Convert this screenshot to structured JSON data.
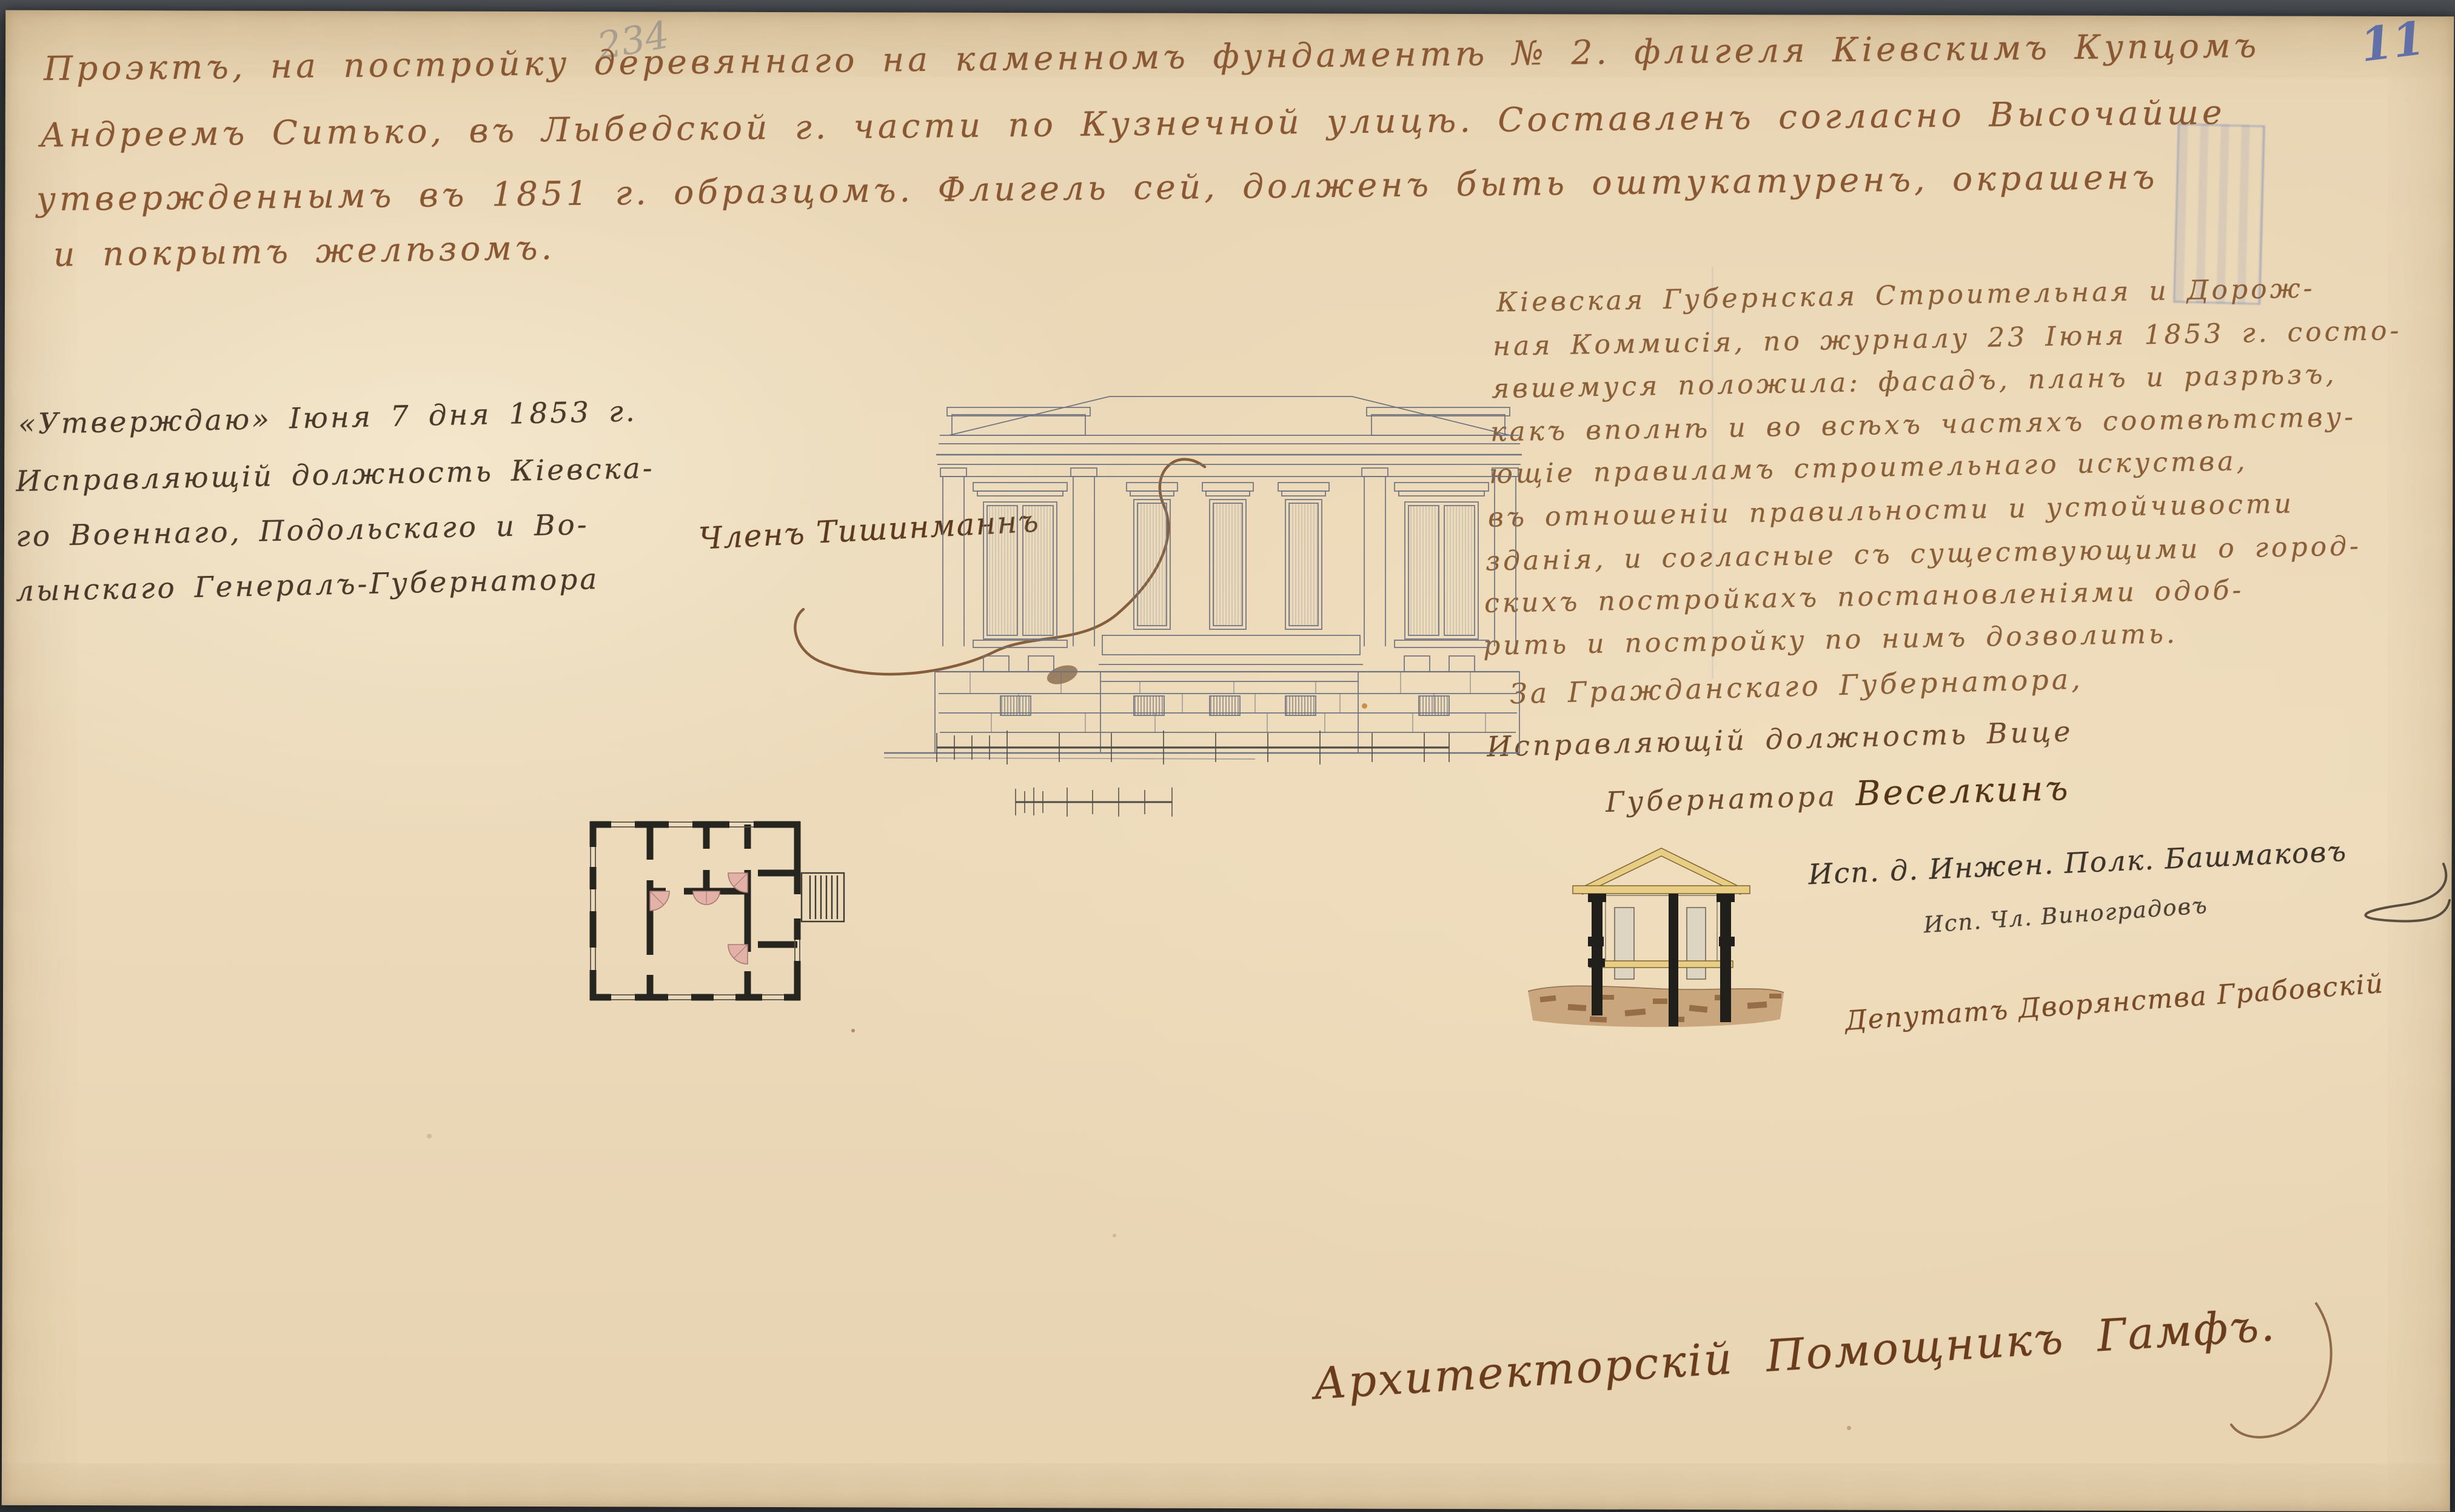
{
  "document": {
    "page_number": "11",
    "pencil_number": "234",
    "title_lines": [
      "Проэктъ, на постройку деревяннаго на каменномъ фундаментѣ № 2. флигеля Кіевскимъ Купцомъ",
      "Андреемъ Ситько, въ Лыбедской г. части по Кузнечной улицѣ. Составленъ согласно Высочайше",
      "утвержденнымъ въ 1851 г. образцомъ. Флигель сей, долженъ быть оштукатуренъ, окрашенъ",
      "и покрытъ желѣзомъ."
    ],
    "approval_block": {
      "lines": [
        "«Утверждаю» Іюня 7 дня 1853 г.",
        "Исправляющій должность Кіевска-",
        "го Военнаго, Подольскаго и Во-",
        "лынскаго Генералъ-Губернатора"
      ]
    },
    "commission_block": {
      "lines": [
        "Кіевская Губернская Строительная и Дорож-",
        "ная Коммисія, по журналу 23 Іюня 1853 г. состо-",
        "явшемуся положила: фасадъ, планъ и разрѣзъ,",
        "какъ вполнѣ и во всѣхъ частяхъ соотвѣтству-",
        "ющіе правиламъ строительнаго искуства,",
        "въ отношеніи правильности и устойчивости",
        "зданія, и согласные съ существующими о город-",
        "скихъ постройкахъ постановленіями одоб-",
        "рить и постройку по нимъ дозволить."
      ],
      "closing_lines": [
        "За Гражданскаго Губернатора,",
        "Исправляющій должность Вице",
        "Губернатора"
      ],
      "governor_signature": "Веселкинъ"
    },
    "member_signature": "Членъ Тишинманнъ",
    "signatures": {
      "engineer": "Исп. д. Инжен. Полк. Башмаковъ",
      "commission_member": "Исп. Чл. Виноградовъ",
      "deputy": "Депутатъ Дворянства Грабовскій",
      "architect": "Архитекторскій Помощникъ Гамфъ."
    }
  },
  "colors": {
    "paper": "#e9d6b6",
    "ink_title": "#8a5733",
    "ink_dark": "#4a392a",
    "ink_commission": "#8a5f38",
    "ink_signature": "#6a3c1c",
    "pencil_blue": "#4c61a8",
    "drawing_line": "#6e7380",
    "roof_wash": "#e9cd85",
    "earth_wash": "#8a5a32",
    "stove_pink": "#e2b1a8",
    "stamp_blue": "#6e7dbe"
  }
}
